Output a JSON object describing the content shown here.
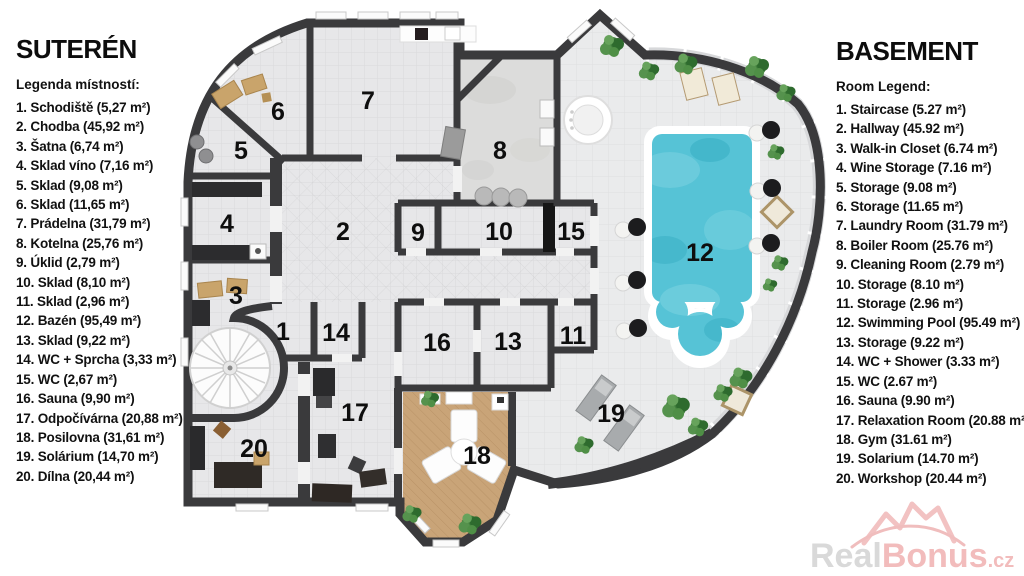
{
  "legend_left": {
    "title": "SUTERÉN",
    "subtitle": "Legenda místností:",
    "items": [
      "1. Schodiště (5,27 m²)",
      "2. Chodba (45,92 m²)",
      "3. Šatna (6,74 m²)",
      "4. Sklad víno (7,16 m²)",
      "5. Sklad (9,08 m²)",
      "6. Sklad (11,65 m²)",
      "7. Prádelna (31,79 m²)",
      "8. Kotelna (25,76 m²)",
      "9. Úklid (2,79 m²)",
      "10. Sklad (8,10 m²)",
      "11. Sklad (2,96 m²)",
      "12. Bazén (95,49 m²)",
      "13. Sklad (9,22 m²)",
      "14. WC + Sprcha (3,33 m²)",
      "15. WC (2,67 m²)",
      "16. Sauna (9,90 m²)",
      "17. Odpočívárna (20,88 m²)",
      "18. Posilovna (31,61 m²)",
      "19. Solárium (14,70 m²)",
      "20. Dílna (20,44 m²)"
    ]
  },
  "legend_right": {
    "title": "BASEMENT",
    "subtitle": "Room Legend:",
    "items": [
      "1. Staircase (5.27 m²)",
      "2. Hallway (45.92 m²)",
      "3. Walk-in Closet (6.74 m²)",
      "4. Wine Storage (7.16 m²)",
      "5. Storage (9.08 m²)",
      "6. Storage (11.65 m²)",
      "7. Laundry Room (31.79 m²)",
      "8. Boiler Room (25.76 m²)",
      "9. Cleaning Room (2.79 m²)",
      "10. Storage (8.10 m²)",
      "11. Storage (2.96 m²)",
      "12. Swimming Pool (95.49 m²)",
      "13. Storage (9.22 m²)",
      "14. WC + Shower (3.33 m²)",
      "15. WC (2.67 m²)",
      "16. Sauna (9.90 m²)",
      "17. Relaxation Room (20.88 m²)",
      "18. Gym (31.61 m²)",
      "19. Solarium (14.70 m²)",
      "20. Workshop (20.44 m²)"
    ]
  },
  "floorplan": {
    "room_numbers": {
      "r1": "1",
      "r2": "2",
      "r3": "3",
      "r4": "4",
      "r5": "5",
      "r6": "6",
      "r7": "7",
      "r8": "8",
      "r9": "9",
      "r10": "10",
      "r11": "11",
      "r12": "12",
      "r13": "13",
      "r14": "14",
      "r15": "15",
      "r16": "16",
      "r17": "17",
      "r18": "18",
      "r19": "19",
      "r20": "20"
    }
  },
  "watermark": {
    "brand_gray": "Real",
    "brand_accent": "Bonus",
    "tld": ".cz"
  },
  "colors": {
    "wall": "#3a3a3c",
    "floor": "#e7e7e9",
    "pool_water": "#56c3d6",
    "gym_floor": "#c9a478",
    "watermark_gray": "#d9d9d9",
    "watermark_pink": "#f2bcbc"
  }
}
